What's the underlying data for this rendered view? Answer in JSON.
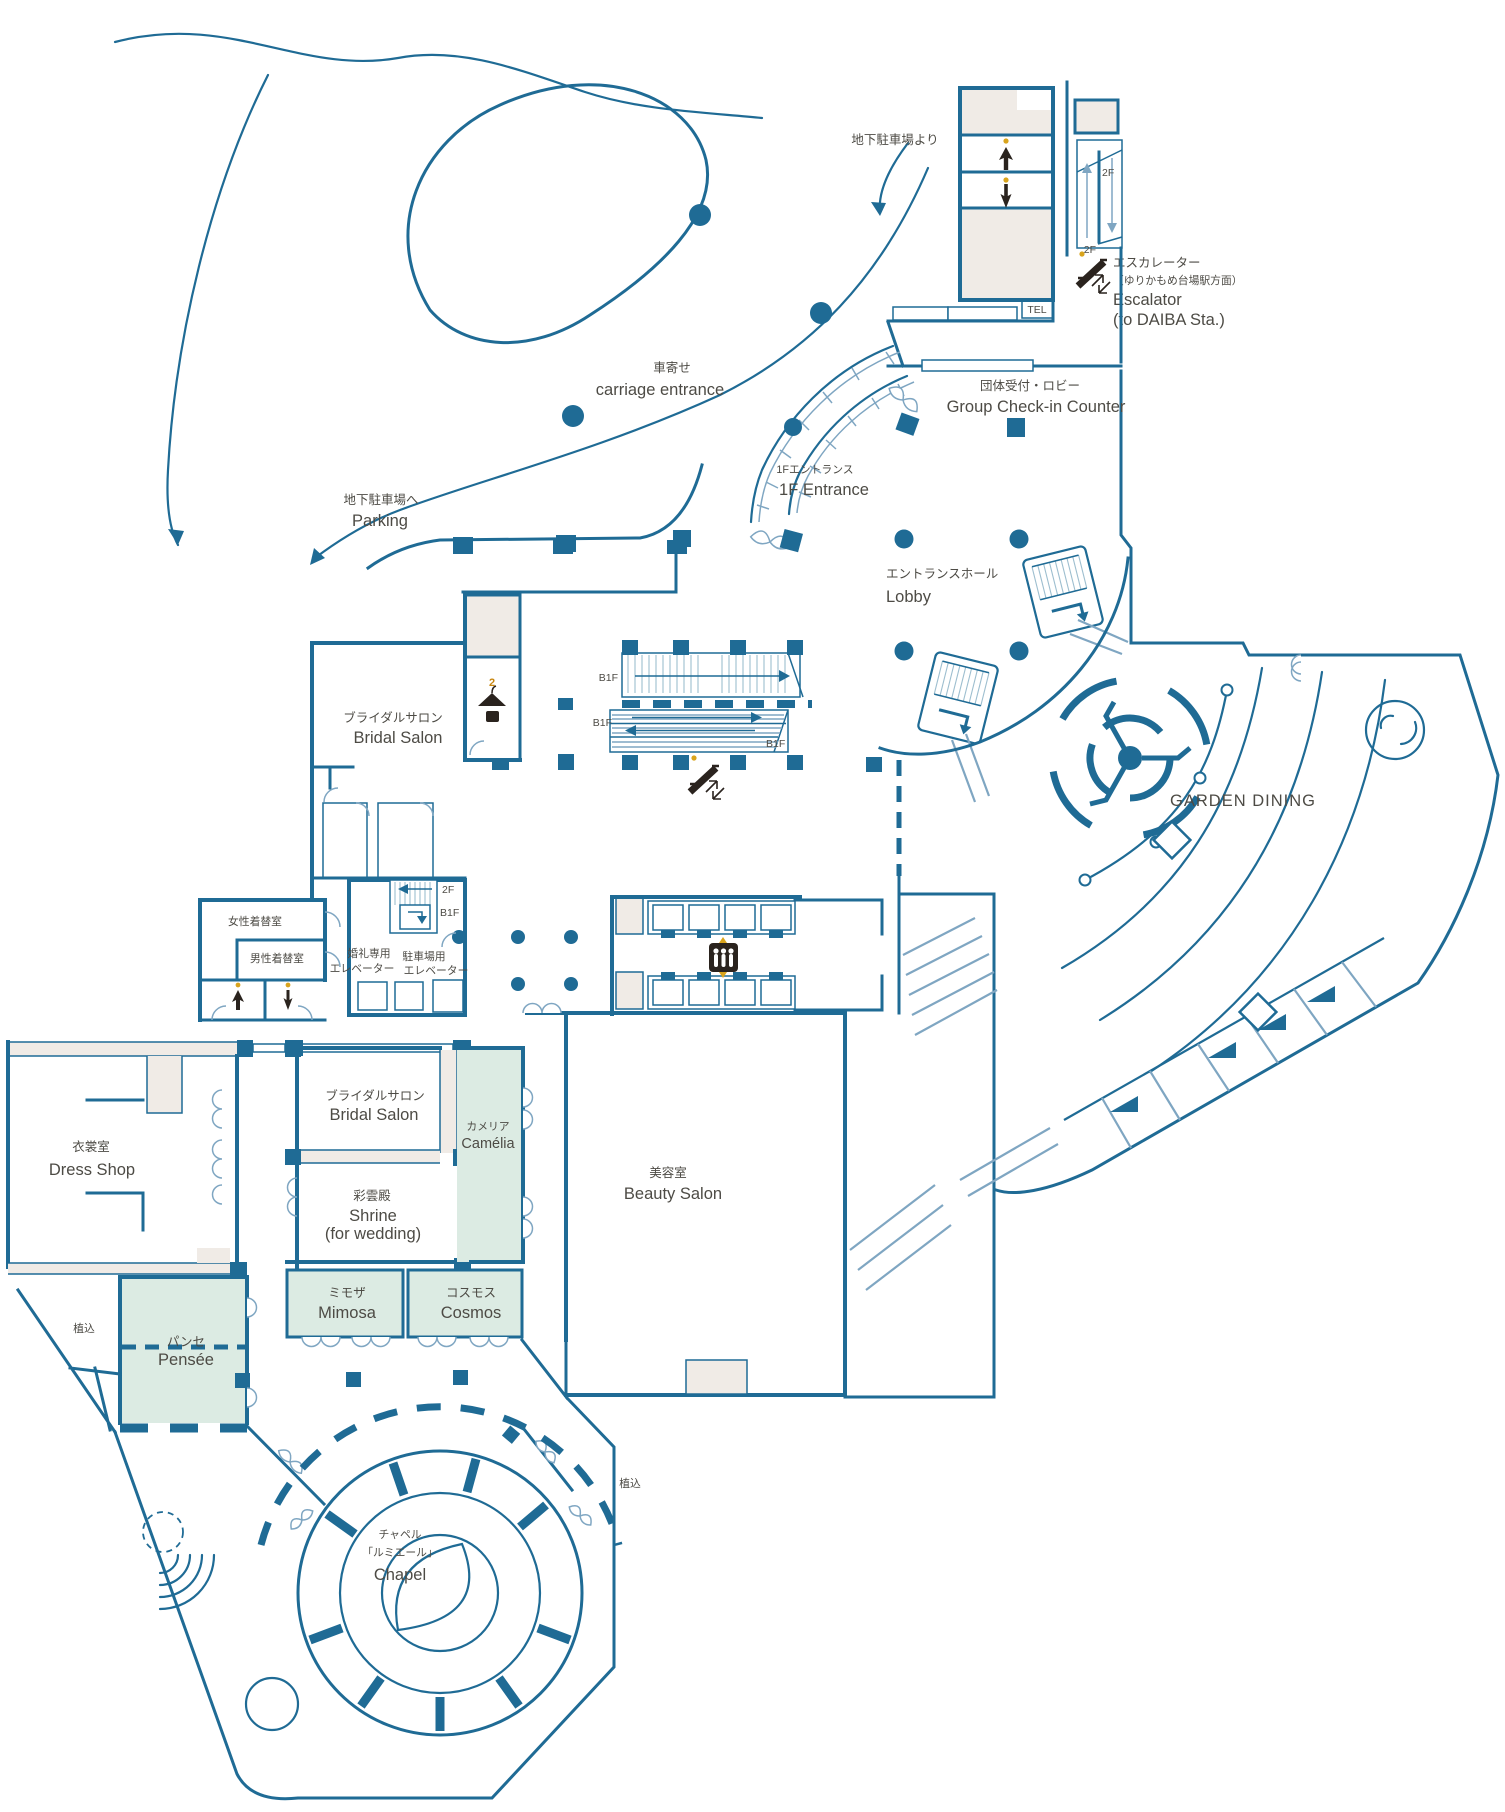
{
  "map": {
    "kind": "hotel 1F floor plan",
    "colors": {
      "wall": "#1f6b95",
      "wall_light": "#7fa6c2",
      "room_beige": "#f0ebe6",
      "room_green": "#dcebe3",
      "text": "#4d4b45",
      "icon_black": "#2a231e",
      "accent_yellow": "#d9a41d",
      "background": "#ffffff"
    },
    "icons": [
      "escalator-icon",
      "elevator-people-icon",
      "cloakroom-icon",
      "up-arrow-icon",
      "down-arrow-icon",
      "parking-route-arrow-icon"
    ],
    "labels": {
      "from_parking": "地下駐車場より",
      "carriage_jp": "車寄せ",
      "carriage_en": "carriage entrance",
      "f2": "2F",
      "b1f": "B1F",
      "escalator_jp": "エスカレーター",
      "escalator_note": "（ゆりかもめ台場駅方面）",
      "escalator_en": "Escalator",
      "escalator_en2": "(to DAIBA Sta.)",
      "tel": "TEL",
      "group_jp": "団体受付・ロビー",
      "group_en": "Group Check-in Counter",
      "ent1f_jp": "1Fエントランス",
      "ent1f_en": "1F Entrance",
      "parking_jp": "地下駐車場へ",
      "parking_en": "Parking",
      "lobby_jp": "エントランスホール",
      "lobby_en": "Lobby",
      "bridal_west_jp": "ブライダルサロン",
      "bridal_west_en": "Bridal Salon",
      "garden_dining": "GARDEN DINING",
      "women_changing": "女性着替室",
      "men_changing": "男性着替室",
      "wedding_elev_1": "婚礼専用",
      "wedding_elev_2": "エレベーター",
      "parking_elev_1": "駐車場用",
      "parking_elev_2": "エレベーター",
      "dress_jp": "衣裳室",
      "dress_en": "Dress Shop",
      "bridal_center_jp": "ブライダルサロン",
      "bridal_center_en": "Bridal Salon",
      "camelia_jp": "カメリア",
      "camelia_en": "Camélia",
      "shrine_jp": "彩雲殿",
      "shrine_en1": "Shrine",
      "shrine_en2": "(for wedding)",
      "beauty_jp": "美容室",
      "beauty_en": "Beauty Salon",
      "mimosa_jp": "ミモザ",
      "mimosa_en": "Mimosa",
      "cosmos_jp": "コスモス",
      "cosmos_en": "Cosmos",
      "pensee_jp": "パンセ",
      "pensee_en": "Pensée",
      "planting": "植込",
      "chapel_jp1": "チャペル",
      "chapel_jp2": "「ルミエール」",
      "chapel_en": "Chapel",
      "cloak_number": "2"
    }
  }
}
